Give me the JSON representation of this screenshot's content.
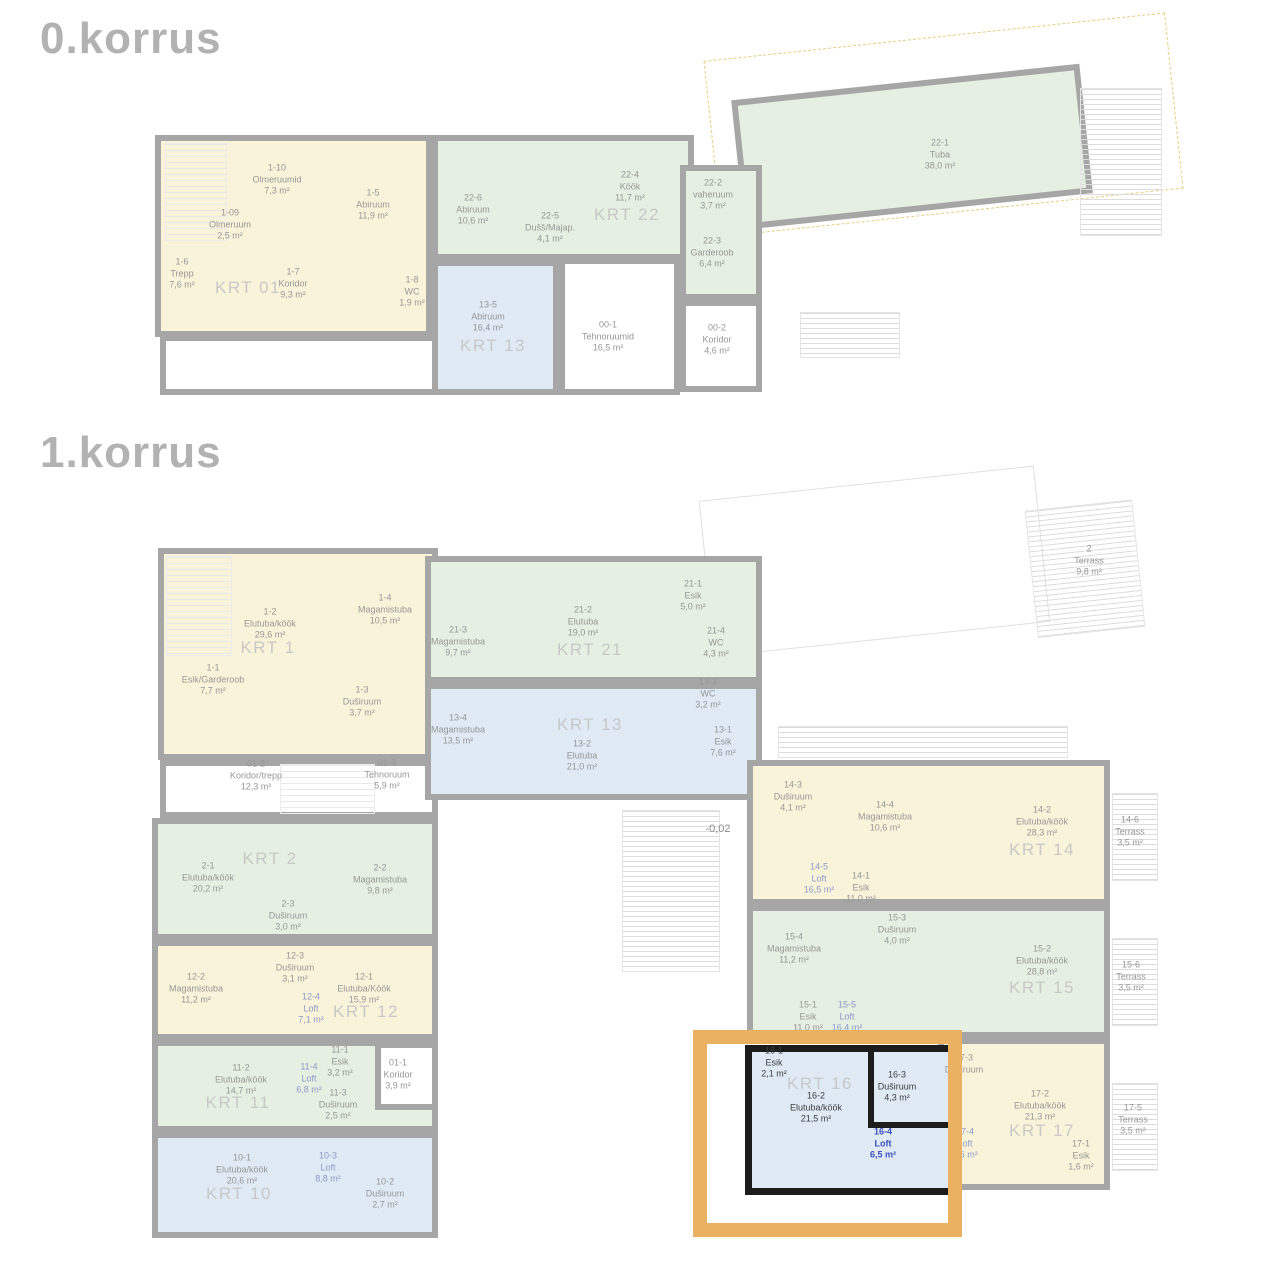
{
  "floor0": {
    "title": "0.korrus",
    "apartments": {
      "krt01": {
        "label": "KRT 01",
        "rooms": {
          "r1_10": {
            "id": "1-10",
            "name": "Olmeruumid",
            "area": "7,3 m²"
          },
          "r1_09": {
            "id": "1-09",
            "name": "Olmeruum",
            "area": "2,5 m²"
          },
          "r1_5": {
            "id": "1-5",
            "name": "Abiruum",
            "area": "11,9 m²"
          },
          "r1_6": {
            "id": "1-6",
            "name": "Trepp",
            "area": "7,6 m²"
          },
          "r1_7": {
            "id": "1-7",
            "name": "Koridor",
            "area": "9,3 m²"
          },
          "r1_8": {
            "id": "1-8",
            "name": "WC",
            "area": "1,9 m²"
          }
        }
      },
      "krt22": {
        "label": "KRT 22",
        "rooms": {
          "r22_6": {
            "id": "22-6",
            "name": "Abiruum",
            "area": "10,6 m²"
          },
          "r22_5": {
            "id": "22-5",
            "name": "Dušš/Majap.",
            "area": "4,1 m²"
          },
          "r22_4": {
            "id": "22-4",
            "name": "Köök",
            "area": "11,7 m²"
          },
          "r22_2": {
            "id": "22-2",
            "name": "vaheruum",
            "area": "3,7 m²"
          },
          "r22_3": {
            "id": "22-3",
            "name": "Garderoob",
            "area": "6,4 m²"
          },
          "r22_1": {
            "id": "22-1",
            "name": "Tuba",
            "area": "38,0 m²"
          }
        }
      },
      "krt13": {
        "label": "KRT 13",
        "rooms": {
          "r13_5": {
            "id": "13-5",
            "name": "Abiruum",
            "area": "16,4 m²"
          }
        }
      }
    },
    "common": {
      "r00_1": {
        "id": "00-1",
        "name": "Tehnoruumid",
        "area": "16,5 m²"
      },
      "r00_2": {
        "id": "00-2",
        "name": "Koridor",
        "area": "4,6 m²"
      }
    }
  },
  "floor1": {
    "title": "1.korrus",
    "level_mark": "-0,02",
    "apartments": {
      "krt1": {
        "label": "KRT 1",
        "rooms": {
          "r1_2": {
            "id": "1-2",
            "name": "Elutuba/köök",
            "area": "29,6 m²"
          },
          "r1_4": {
            "id": "1-4",
            "name": "Magamistuba",
            "area": "10,5 m²"
          },
          "r1_1": {
            "id": "1-1",
            "name": "Esik/Garderoob",
            "area": "7,7 m²"
          },
          "r1_3": {
            "id": "1-3",
            "name": "Duširuum",
            "area": "3,7 m²"
          }
        }
      },
      "krt2": {
        "label": "KRT 2",
        "rooms": {
          "r2_1": {
            "id": "2-1",
            "name": "Elutuba/köök",
            "area": "20,2 m²"
          },
          "r2_2": {
            "id": "2-2",
            "name": "Magamistuba",
            "area": "9,8 m²"
          },
          "r2_3": {
            "id": "2-3",
            "name": "Duširuum",
            "area": "3,0 m²"
          }
        }
      },
      "krt12": {
        "label": "KRT 12",
        "rooms": {
          "r12_2": {
            "id": "12-2",
            "name": "Magamistuba",
            "area": "11,2 m²"
          },
          "r12_3": {
            "id": "12-3",
            "name": "Duširuum",
            "area": "3,1 m²"
          },
          "r12_4": {
            "id": "12-4",
            "name": "Loft",
            "area": "7,1 m²"
          },
          "r12_1": {
            "id": "12-1",
            "name": "Elutuba/Köök",
            "area": "15,9 m²"
          }
        }
      },
      "krt11": {
        "label": "KRT 11",
        "rooms": {
          "r11_2": {
            "id": "11-2",
            "name": "Elutuba/köök",
            "area": "14,7 m²"
          },
          "r11_4": {
            "id": "11-4",
            "name": "Loft",
            "area": "6,8 m²"
          },
          "r11_1": {
            "id": "11-1",
            "name": "Esik",
            "area": "3,2 m²"
          },
          "r11_3": {
            "id": "11-3",
            "name": "Duširuum",
            "area": "2,5 m²"
          }
        }
      },
      "krt10": {
        "label": "KRT 10",
        "rooms": {
          "r10_1": {
            "id": "10-1",
            "name": "Elutuba/köök",
            "area": "20,6 m²"
          },
          "r10_3": {
            "id": "10-3",
            "name": "Loft",
            "area": "8,8 m²"
          },
          "r10_2": {
            "id": "10-2",
            "name": "Duširuum",
            "area": "2,7 m²"
          }
        }
      },
      "krt21": {
        "label": "KRT 21",
        "rooms": {
          "r21_3": {
            "id": "21-3",
            "name": "Magamistuba",
            "area": "9,7 m²"
          },
          "r21_2": {
            "id": "21-2",
            "name": "Elutuba",
            "area": "19,0 m²"
          },
          "r21_1": {
            "id": "21-1",
            "name": "Esik",
            "area": "5,0 m²"
          },
          "r21_4": {
            "id": "21-4",
            "name": "WC",
            "area": "4,3 m²"
          }
        }
      },
      "krt13": {
        "label": "KRT 13",
        "rooms": {
          "r13_4": {
            "id": "13-4",
            "name": "Magamistuba",
            "area": "13,5 m²"
          },
          "r13_2": {
            "id": "13-2",
            "name": "Elutuba",
            "area": "21,0 m²"
          },
          "r13_3": {
            "id": "13-3",
            "name": "WC",
            "area": "3,2 m²"
          },
          "r13_1": {
            "id": "13-1",
            "name": "Esik",
            "area": "7,6 m²"
          }
        }
      },
      "krt14": {
        "label": "KRT 14",
        "rooms": {
          "r14_3": {
            "id": "14-3",
            "name": "Duširuum",
            "area": "4,1 m²"
          },
          "r14_4": {
            "id": "14-4",
            "name": "Magamistuba",
            "area": "10,6 m²"
          },
          "r14_2": {
            "id": "14-2",
            "name": "Elutuba/köök",
            "area": "28,3 m²"
          },
          "r14_5": {
            "id": "14-5",
            "name": "Loft",
            "area": "16,5 m²"
          },
          "r14_1": {
            "id": "14-1",
            "name": "Esik",
            "area": "11,0 m²"
          },
          "r14_6": {
            "id": "14-6",
            "name": "Terrass",
            "area": "3,5 m²"
          }
        }
      },
      "krt15": {
        "label": "KRT 15",
        "rooms": {
          "r15_4": {
            "id": "15-4",
            "name": "Magamistuba",
            "area": "11,2 m²"
          },
          "r15_3": {
            "id": "15-3",
            "name": "Duširuum",
            "area": "4,0 m²"
          },
          "r15_2": {
            "id": "15-2",
            "name": "Elutuba/köök",
            "area": "28,8 m²"
          },
          "r15_1": {
            "id": "15-1",
            "name": "Esik",
            "area": "11,0 m²"
          },
          "r15_5": {
            "id": "15-5",
            "name": "Loft",
            "area": "16,4 m²"
          },
          "r15_6": {
            "id": "15-6",
            "name": "Terrass",
            "area": "3,5 m²"
          }
        }
      },
      "krt16": {
        "label": "KRT 16",
        "highlighted": true,
        "rooms": {
          "r16_1": {
            "id": "16-1",
            "name": "Esik",
            "area": "2,1 m²"
          },
          "r16_2": {
            "id": "16-2",
            "name": "Elutuba/köök",
            "area": "21,5 m²"
          },
          "r16_3": {
            "id": "16-3",
            "name": "Duširuum",
            "area": "4,3 m²"
          },
          "r16_4": {
            "id": "16-4",
            "name": "Loft",
            "area": "6,5 m²"
          }
        }
      },
      "krt17": {
        "label": "KRT 17",
        "rooms": {
          "r17_3": {
            "id": "17-3",
            "name": "Duširuum",
            "area": ""
          },
          "r17_4": {
            "id": "17-4",
            "name": "Loft",
            "area": "6,6 m²"
          },
          "r17_2": {
            "id": "17-2",
            "name": "Elutuba/köök",
            "area": "21,3 m²"
          },
          "r17_1": {
            "id": "17-1",
            "name": "Esik",
            "area": "1,6 m²"
          },
          "r17_5": {
            "id": "17-5",
            "name": "Terrass",
            "area": "3,5 m²"
          }
        }
      }
    },
    "common": {
      "r01_2": {
        "id": "01-2",
        "name": "Koridor/trepp",
        "area": "12,3 m²"
      },
      "r01_3": {
        "id": "01-3",
        "name": "Tehnoruum",
        "area": "5,9 m²"
      },
      "r01_1": {
        "id": "01-1",
        "name": "Koridor",
        "area": "3,9 m²"
      },
      "r2t": {
        "id": "2",
        "name": "Terrass",
        "area": "9,8 m²"
      }
    }
  },
  "colors": {
    "apartment_yellow": "#f9f3da",
    "apartment_green": "#e5efe2",
    "apartment_blue": "#dfeaf5",
    "wall_gray": "#a6a6a6",
    "wall_highlight": "#1c1c1c",
    "highlight_orange": "#ebb162",
    "loft_text_blue": "#3c51be"
  }
}
